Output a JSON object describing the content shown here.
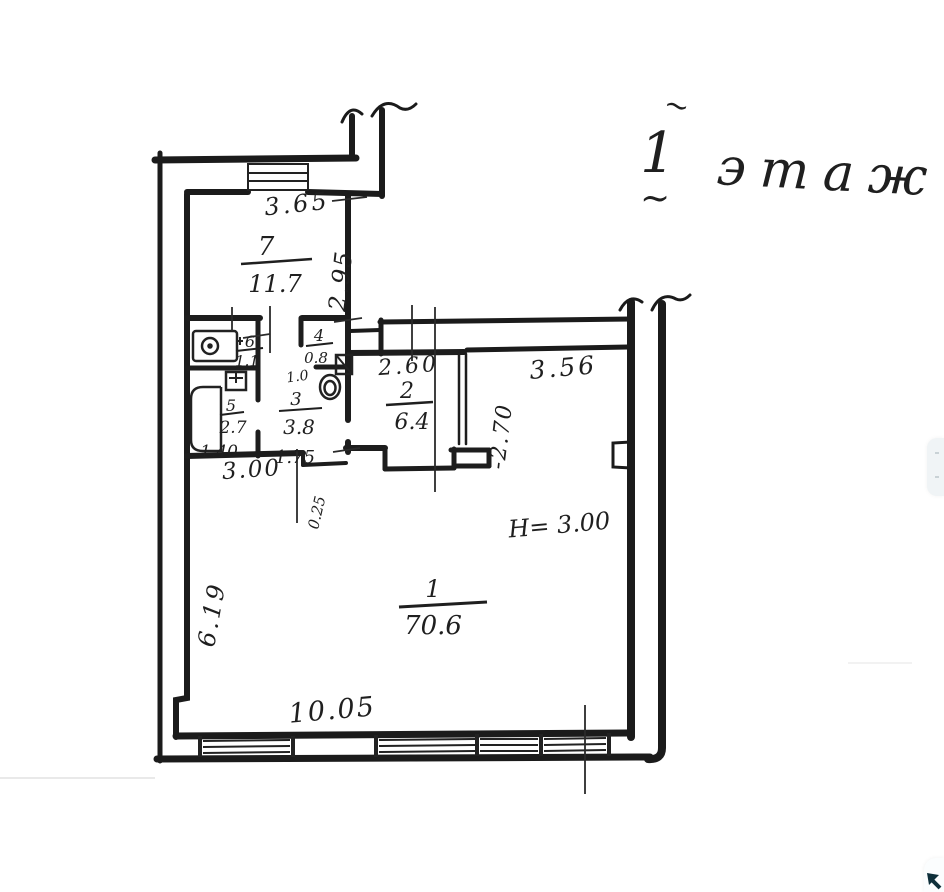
{
  "title": {
    "tilde": "~",
    "number": "1",
    "word": "этаж"
  },
  "rooms": {
    "r1": {
      "number": "1",
      "area": "70.6"
    },
    "r2": {
      "number": "2",
      "area": "6.4"
    },
    "r3": {
      "number": "3",
      "area": "3.8"
    },
    "r4": {
      "number": "4",
      "area": "0.8"
    },
    "r5": {
      "number": "5",
      "area": "2.7"
    },
    "r6": {
      "number": "6",
      "area": "1.1"
    },
    "r7": {
      "number": "7",
      "area": "11.7"
    }
  },
  "dimensions": {
    "room7_width": "3.65",
    "room7_depth": "2.95",
    "room2_width": "2.60",
    "room2_depth": "-2.70",
    "top_right_wall": "3.56",
    "hall_width": "3.00",
    "room3_width": "1.75",
    "room5_width": "1.40",
    "room4_width": "1.0",
    "wall_offset": "0.25",
    "left_wall": "6.19",
    "bottom_wall": "10.05",
    "ceiling_height": "H= 3.00"
  }
}
